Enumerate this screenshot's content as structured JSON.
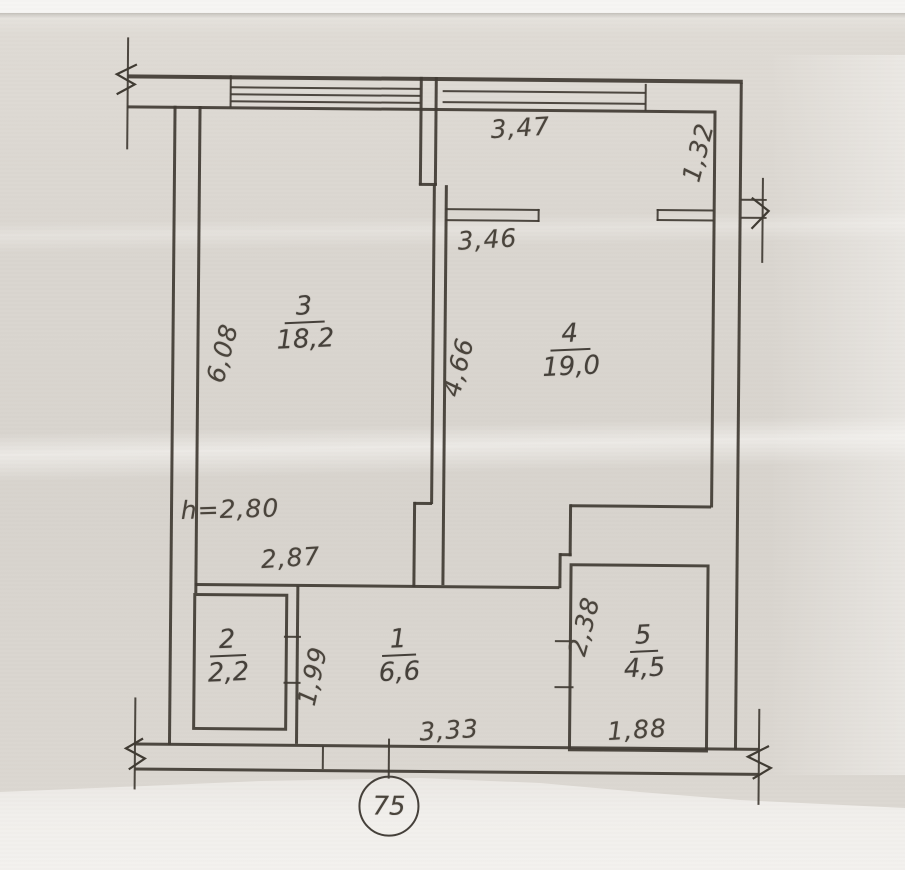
{
  "plan": {
    "rooms": [
      {
        "id": "room-3",
        "number": "3",
        "area": "18,2"
      },
      {
        "id": "room-4",
        "number": "4",
        "area": "19,0"
      },
      {
        "id": "room-1",
        "number": "1",
        "area": "6,6"
      },
      {
        "id": "room-2",
        "number": "2",
        "area": "2,2"
      },
      {
        "id": "room-5",
        "number": "5",
        "area": "4,5"
      }
    ],
    "dimensions": {
      "top_window_width": "3,47",
      "top_right_depth": "1,32",
      "room4_opening_width": "3,46",
      "middle_wall_length": "4,66",
      "room3_depth": "6,08",
      "ceiling_height": "h=2,80",
      "room3_width": "2,87",
      "room5_depth": "2,38",
      "room1_depth": "1,99",
      "room1_width": "3,33",
      "room5_width": "1,88"
    },
    "axis_marker": "75",
    "colors": {
      "ink": "#403b33",
      "paper": "#d9d5cf"
    }
  }
}
